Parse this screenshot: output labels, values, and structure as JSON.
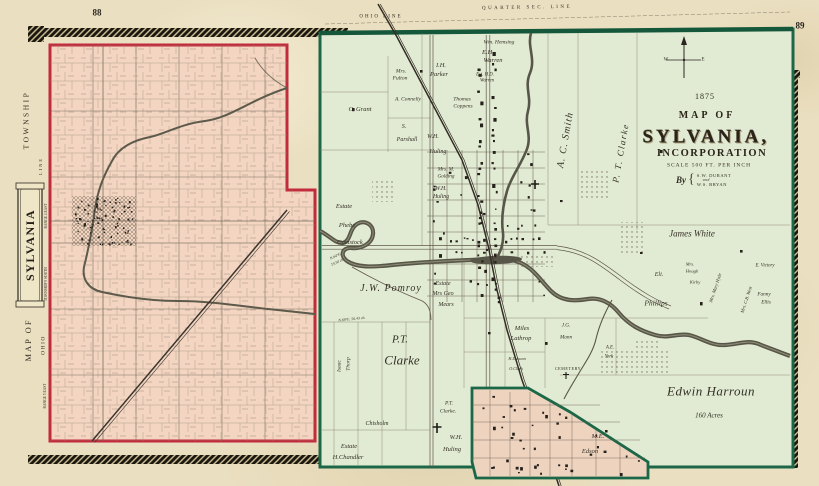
{
  "page": {
    "left_number": "88",
    "right_number": "89"
  },
  "township_map": {
    "name": "Map of Sylvania Township",
    "labels": [
      {
        "t": "TOWNSHIP",
        "x": 26,
        "y": 120,
        "s": 7.5,
        "sp": 2.5,
        "r": -90,
        "c": "caps"
      },
      {
        "t": "SYLVANIA",
        "x": 30,
        "y": 245,
        "s": 12,
        "sp": 1.5,
        "r": -90,
        "c": "cart"
      },
      {
        "t": "MAP OF",
        "x": 28,
        "y": 340,
        "s": 8.5,
        "sp": 2,
        "r": -90,
        "c": "caps"
      },
      {
        "t": "OHIO",
        "x": 44,
        "y": 345,
        "s": 5.5,
        "sp": 1.5,
        "r": -90,
        "c": "caps"
      },
      {
        "t": "LINE",
        "x": 41,
        "y": 166,
        "s": 4.5,
        "sp": 2,
        "r": -90,
        "c": "caps"
      },
      {
        "t": "RANGE 4 EAST",
        "x": 47,
        "y": 216,
        "s": 3.6,
        "r": -90,
        "c": "caps"
      },
      {
        "t": "TOWNSHIP 9 SOUTH",
        "x": 47,
        "y": 284,
        "s": 3.6,
        "r": -90,
        "c": "caps"
      },
      {
        "t": "RANGE 5 EAST",
        "x": 46,
        "y": 396,
        "s": 3.6,
        "r": -90,
        "c": "caps"
      }
    ]
  },
  "incorporation_map": {
    "name": "Map of Sylvania Incorporation",
    "title": {
      "year": "1875",
      "line1": "MAP OF",
      "line2": "SYLVANIA,",
      "line3": "INCORPORATION",
      "scale": "SCALE 500 FT. PER INCH",
      "by": "By",
      "brace": "{",
      "publisher1": "S.W. DURANT",
      "publisher2": "and",
      "publisher3": "W.S. BRYAN"
    },
    "compass": {
      "west": "W",
      "east": "E"
    },
    "labels": [
      {
        "t": "OHIO LINE",
        "x": 381,
        "y": 17,
        "s": 5,
        "sp": 2,
        "c": "caps"
      },
      {
        "t": "QUARTER SEC. LINE",
        "x": 527,
        "y": 8,
        "s": 5,
        "sp": 2.5,
        "c": "caps",
        "r": -1
      },
      {
        "t": "Wm. Hemsing",
        "x": 499,
        "y": 43,
        "s": 5.5
      },
      {
        "t": "E.H.",
        "x": 488,
        "y": 53,
        "s": 6.5
      },
      {
        "t": "Warren",
        "x": 493,
        "y": 61,
        "s": 6.5
      },
      {
        "t": "Est. H.D.",
        "x": 485,
        "y": 76,
        "s": 4.8
      },
      {
        "t": "Warren",
        "x": 487,
        "y": 82,
        "s": 4.8
      },
      {
        "t": "I.H.",
        "x": 441,
        "y": 66,
        "s": 6.5
      },
      {
        "t": "Parker",
        "x": 439,
        "y": 75,
        "s": 6.5
      },
      {
        "t": "Mrs.",
        "x": 401,
        "y": 72,
        "s": 5.5
      },
      {
        "t": "Fulton",
        "x": 400,
        "y": 79,
        "s": 5.5
      },
      {
        "t": "A. Connelly",
        "x": 408,
        "y": 100,
        "s": 5.5
      },
      {
        "t": "Thomas",
        "x": 462,
        "y": 100,
        "s": 5.5
      },
      {
        "t": "Coppens",
        "x": 463,
        "y": 107,
        "s": 5.5
      },
      {
        "t": "C. Grant",
        "x": 360,
        "y": 110,
        "s": 6.5
      },
      {
        "t": "S.",
        "x": 404,
        "y": 127,
        "s": 6
      },
      {
        "t": "Parshall",
        "x": 407,
        "y": 140,
        "s": 6
      },
      {
        "t": "W.H.",
        "x": 433,
        "y": 137,
        "s": 6
      },
      {
        "t": "Huling",
        "x": 438,
        "y": 152,
        "s": 6
      },
      {
        "t": "Mrs. M.",
        "x": 446,
        "y": 170,
        "s": 5.2
      },
      {
        "t": "Golding",
        "x": 446,
        "y": 177,
        "s": 5.2
      },
      {
        "t": "W.H.",
        "x": 441,
        "y": 190,
        "s": 5.8
      },
      {
        "t": "Huling",
        "x": 441,
        "y": 198,
        "s": 5.8
      },
      {
        "t": "A. C. Smith",
        "x": 566,
        "y": 140,
        "s": 10,
        "sp": 1,
        "r": -80
      },
      {
        "t": "P. T. Clarke",
        "x": 621,
        "y": 153,
        "s": 9,
        "sp": 1.5,
        "r": -80
      },
      {
        "t": "James White",
        "x": 692,
        "y": 234,
        "s": 9
      },
      {
        "t": "Eli.",
        "x": 659,
        "y": 275,
        "s": 6
      },
      {
        "t": "Phillips",
        "x": 656,
        "y": 303,
        "s": 7.5
      },
      {
        "t": "Mrs.",
        "x": 690,
        "y": 265,
        "s": 4.6
      },
      {
        "t": "Hough",
        "x": 692,
        "y": 272,
        "s": 4.6
      },
      {
        "t": "Kirby",
        "x": 695,
        "y": 283,
        "s": 4.6
      },
      {
        "t": "E. Victory",
        "x": 765,
        "y": 267,
        "s": 4.8
      },
      {
        "t": "Fanny",
        "x": 764,
        "y": 295,
        "s": 5.2
      },
      {
        "t": "Ellis",
        "x": 766,
        "y": 303,
        "s": 5.2
      },
      {
        "t": "Mrs. Mary Hyde",
        "x": 716,
        "y": 288,
        "s": 4.6,
        "r": -72
      },
      {
        "t": "Mrs. C.B. West",
        "x": 747,
        "y": 300,
        "s": 4.6,
        "r": -72
      },
      {
        "t": "Edwin Harroun",
        "x": 711,
        "y": 391,
        "s": 13,
        "sp": 0.5
      },
      {
        "t": "160 Acres",
        "x": 709,
        "y": 416,
        "s": 7
      },
      {
        "t": "M.E.",
        "x": 598,
        "y": 437,
        "s": 6.5
      },
      {
        "t": "Edson",
        "x": 590,
        "y": 452,
        "s": 6.5
      },
      {
        "t": "Miles",
        "x": 522,
        "y": 329,
        "s": 6.5
      },
      {
        "t": "Lathrop",
        "x": 521,
        "y": 339,
        "s": 6.5
      },
      {
        "t": "J.G.",
        "x": 566,
        "y": 326,
        "s": 5.2
      },
      {
        "t": "Mann",
        "x": 566,
        "y": 338,
        "s": 5.2
      },
      {
        "t": "H.Duncan",
        "x": 517,
        "y": 359,
        "s": 4.2
      },
      {
        "t": "O.Clark",
        "x": 516,
        "y": 369,
        "s": 4.2
      },
      {
        "t": "CEMETERY",
        "x": 568,
        "y": 369,
        "s": 4.2,
        "sp": 0.5,
        "c": "caps"
      },
      {
        "t": "A.E.",
        "x": 610,
        "y": 349,
        "s": 4.8
      },
      {
        "t": "York",
        "x": 609,
        "y": 358,
        "s": 4.8
      },
      {
        "t": "P.T.",
        "x": 400,
        "y": 340,
        "s": 11
      },
      {
        "t": "Clarke",
        "x": 402,
        "y": 360,
        "s": 13
      },
      {
        "t": "J.W. Pomroy",
        "x": 391,
        "y": 289,
        "s": 10,
        "sp": 1
      },
      {
        "t": "Estate",
        "x": 443,
        "y": 284,
        "s": 6
      },
      {
        "t": "Mrs Geo",
        "x": 443,
        "y": 294,
        "s": 6
      },
      {
        "t": "Mears",
        "x": 446,
        "y": 305,
        "s": 6
      },
      {
        "t": "Estate",
        "x": 344,
        "y": 207,
        "s": 6.5
      },
      {
        "t": "Phebe",
        "x": 347,
        "y": 226,
        "s": 6.5
      },
      {
        "t": "Comstock",
        "x": 350,
        "y": 243,
        "s": 6.5
      },
      {
        "t": "N.64°E.",
        "x": 336,
        "y": 257,
        "s": 3.8,
        "r": -25
      },
      {
        "t": "19.50 ch.",
        "x": 338,
        "y": 263,
        "s": 3.8,
        "r": -25
      },
      {
        "t": "N.69°E. 56.43 ch.",
        "x": 352,
        "y": 320,
        "s": 3.8,
        "r": -6
      },
      {
        "t": "Isaac",
        "x": 340,
        "y": 366,
        "s": 5.5,
        "r": -90
      },
      {
        "t": "Thorp",
        "x": 349,
        "y": 364,
        "s": 5.5,
        "r": -90
      },
      {
        "t": "Estate",
        "x": 349,
        "y": 447,
        "s": 6.5
      },
      {
        "t": "H.Chandler",
        "x": 348,
        "y": 458,
        "s": 6.5
      },
      {
        "t": "Chisholm",
        "x": 377,
        "y": 424,
        "s": 6
      },
      {
        "t": "P.T.",
        "x": 449,
        "y": 404,
        "s": 5.5
      },
      {
        "t": "Clarke.",
        "x": 448,
        "y": 412,
        "s": 5.5
      },
      {
        "t": "W.H.",
        "x": 456,
        "y": 438,
        "s": 6.5
      },
      {
        "t": "Huling",
        "x": 452,
        "y": 450,
        "s": 6.5
      }
    ]
  }
}
